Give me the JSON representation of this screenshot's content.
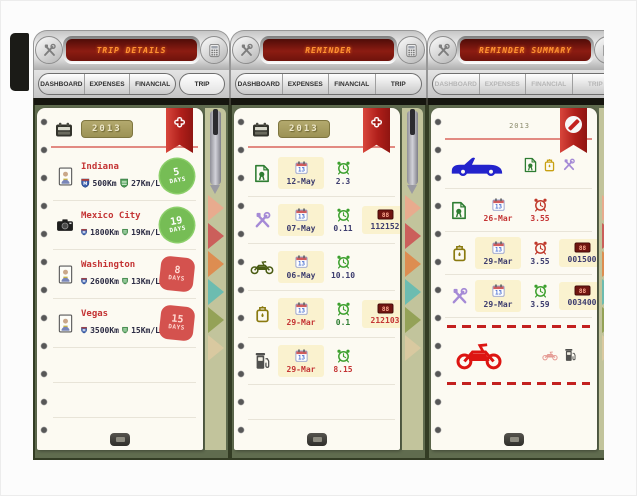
{
  "colors": {
    "lcd_text": "#ff9433",
    "lcd_bg": "#6e130c",
    "ribbon_red": "#b01f1a",
    "badge_green": "#76bd55",
    "badge_red": "#d4524e",
    "year_badge": "#a89f63",
    "page_cream": "#fcfaf2",
    "frame_olive": "#606c4f",
    "cell_yellow": "#faf2cf",
    "navy_text": "#3c3c6e",
    "red_text": "#c43434",
    "alarm_green": "#3da02e",
    "alarm_red": "#c0392b"
  },
  "icons": {
    "header_left": "tools-icon",
    "header_right": "calculator-icon",
    "add": "✚",
    "block": "no-entry-icon",
    "year": "calendar-icon",
    "date": "calendar-icon",
    "time": "alarm-clock-icon",
    "odometer": "odometer-icon"
  },
  "panels": [
    {
      "title": "TRIP DETAILS",
      "tabs": [
        "DASHBOARD",
        "EXPENSES",
        "FINANCIAL",
        "TRIP"
      ],
      "active_tab": "TRIP",
      "year": "2013",
      "trips": [
        {
          "name": "Indiana",
          "icon": "portrait-photo",
          "distance": "500Km",
          "efficiency": "27Km/L",
          "days_num": "5",
          "days_word": "DAYS",
          "badge": "green"
        },
        {
          "name": "Mexico City",
          "icon": "camera",
          "distance": "1800Km",
          "efficiency": "19Km/L",
          "days_num": "19",
          "days_word": "DAYS",
          "badge": "green"
        },
        {
          "name": "Washington",
          "icon": "portrait-photo",
          "distance": "2600Km",
          "efficiency": "13Km/L",
          "days_num": "8",
          "days_word": "DAYS",
          "badge": "red"
        },
        {
          "name": "Vegas",
          "icon": "portrait-photo",
          "distance": "3500Km",
          "efficiency": "15Km/L",
          "days_num": "15",
          "days_word": "DAYS",
          "badge": "red"
        }
      ]
    },
    {
      "title": "REMINDER",
      "tabs": [
        "DASHBOARD",
        "EXPENSES",
        "FINANCIAL",
        "TRIP"
      ],
      "year": "2013",
      "reminders": [
        {
          "type": "certificate",
          "date": "12-May",
          "time": "2.3",
          "odometer": ""
        },
        {
          "type": "service-tools",
          "date": "07-May",
          "time": "0.11",
          "odometer": "112152"
        },
        {
          "type": "motorcycle",
          "date": "06-May",
          "time": "10.10",
          "odometer": ""
        },
        {
          "type": "oil",
          "date": "29-Mar",
          "time": "0.1",
          "odometer": "212103"
        },
        {
          "type": "fuel",
          "date": "29-Mar",
          "time": "8.15",
          "odometer": ""
        }
      ]
    },
    {
      "title": "REMINDER SUMMARY",
      "tabs": [
        "DASHBOARD",
        "EXPENSES",
        "FINANCIAL",
        "TRIP"
      ],
      "year": "2013",
      "vehicle_row": {
        "vehicle": "car",
        "reminder_types": [
          "certificate",
          "oil",
          "service-tools"
        ]
      },
      "summary": [
        {
          "type": "certificate",
          "date": "26-Mar",
          "time": "3.55",
          "odometer": "",
          "alarm": "red"
        },
        {
          "type": "oil",
          "date": "29-Mar",
          "time": "3.55",
          "odometer": "001500",
          "alarm": "red"
        },
        {
          "type": "service-tools",
          "date": "29-Mar",
          "time": "3.59",
          "odometer": "003400",
          "alarm": "green"
        }
      ],
      "excluded_row": {
        "vehicle": "motorcycle",
        "reminder_types": [
          "scooter",
          "fuel"
        ]
      }
    }
  ]
}
